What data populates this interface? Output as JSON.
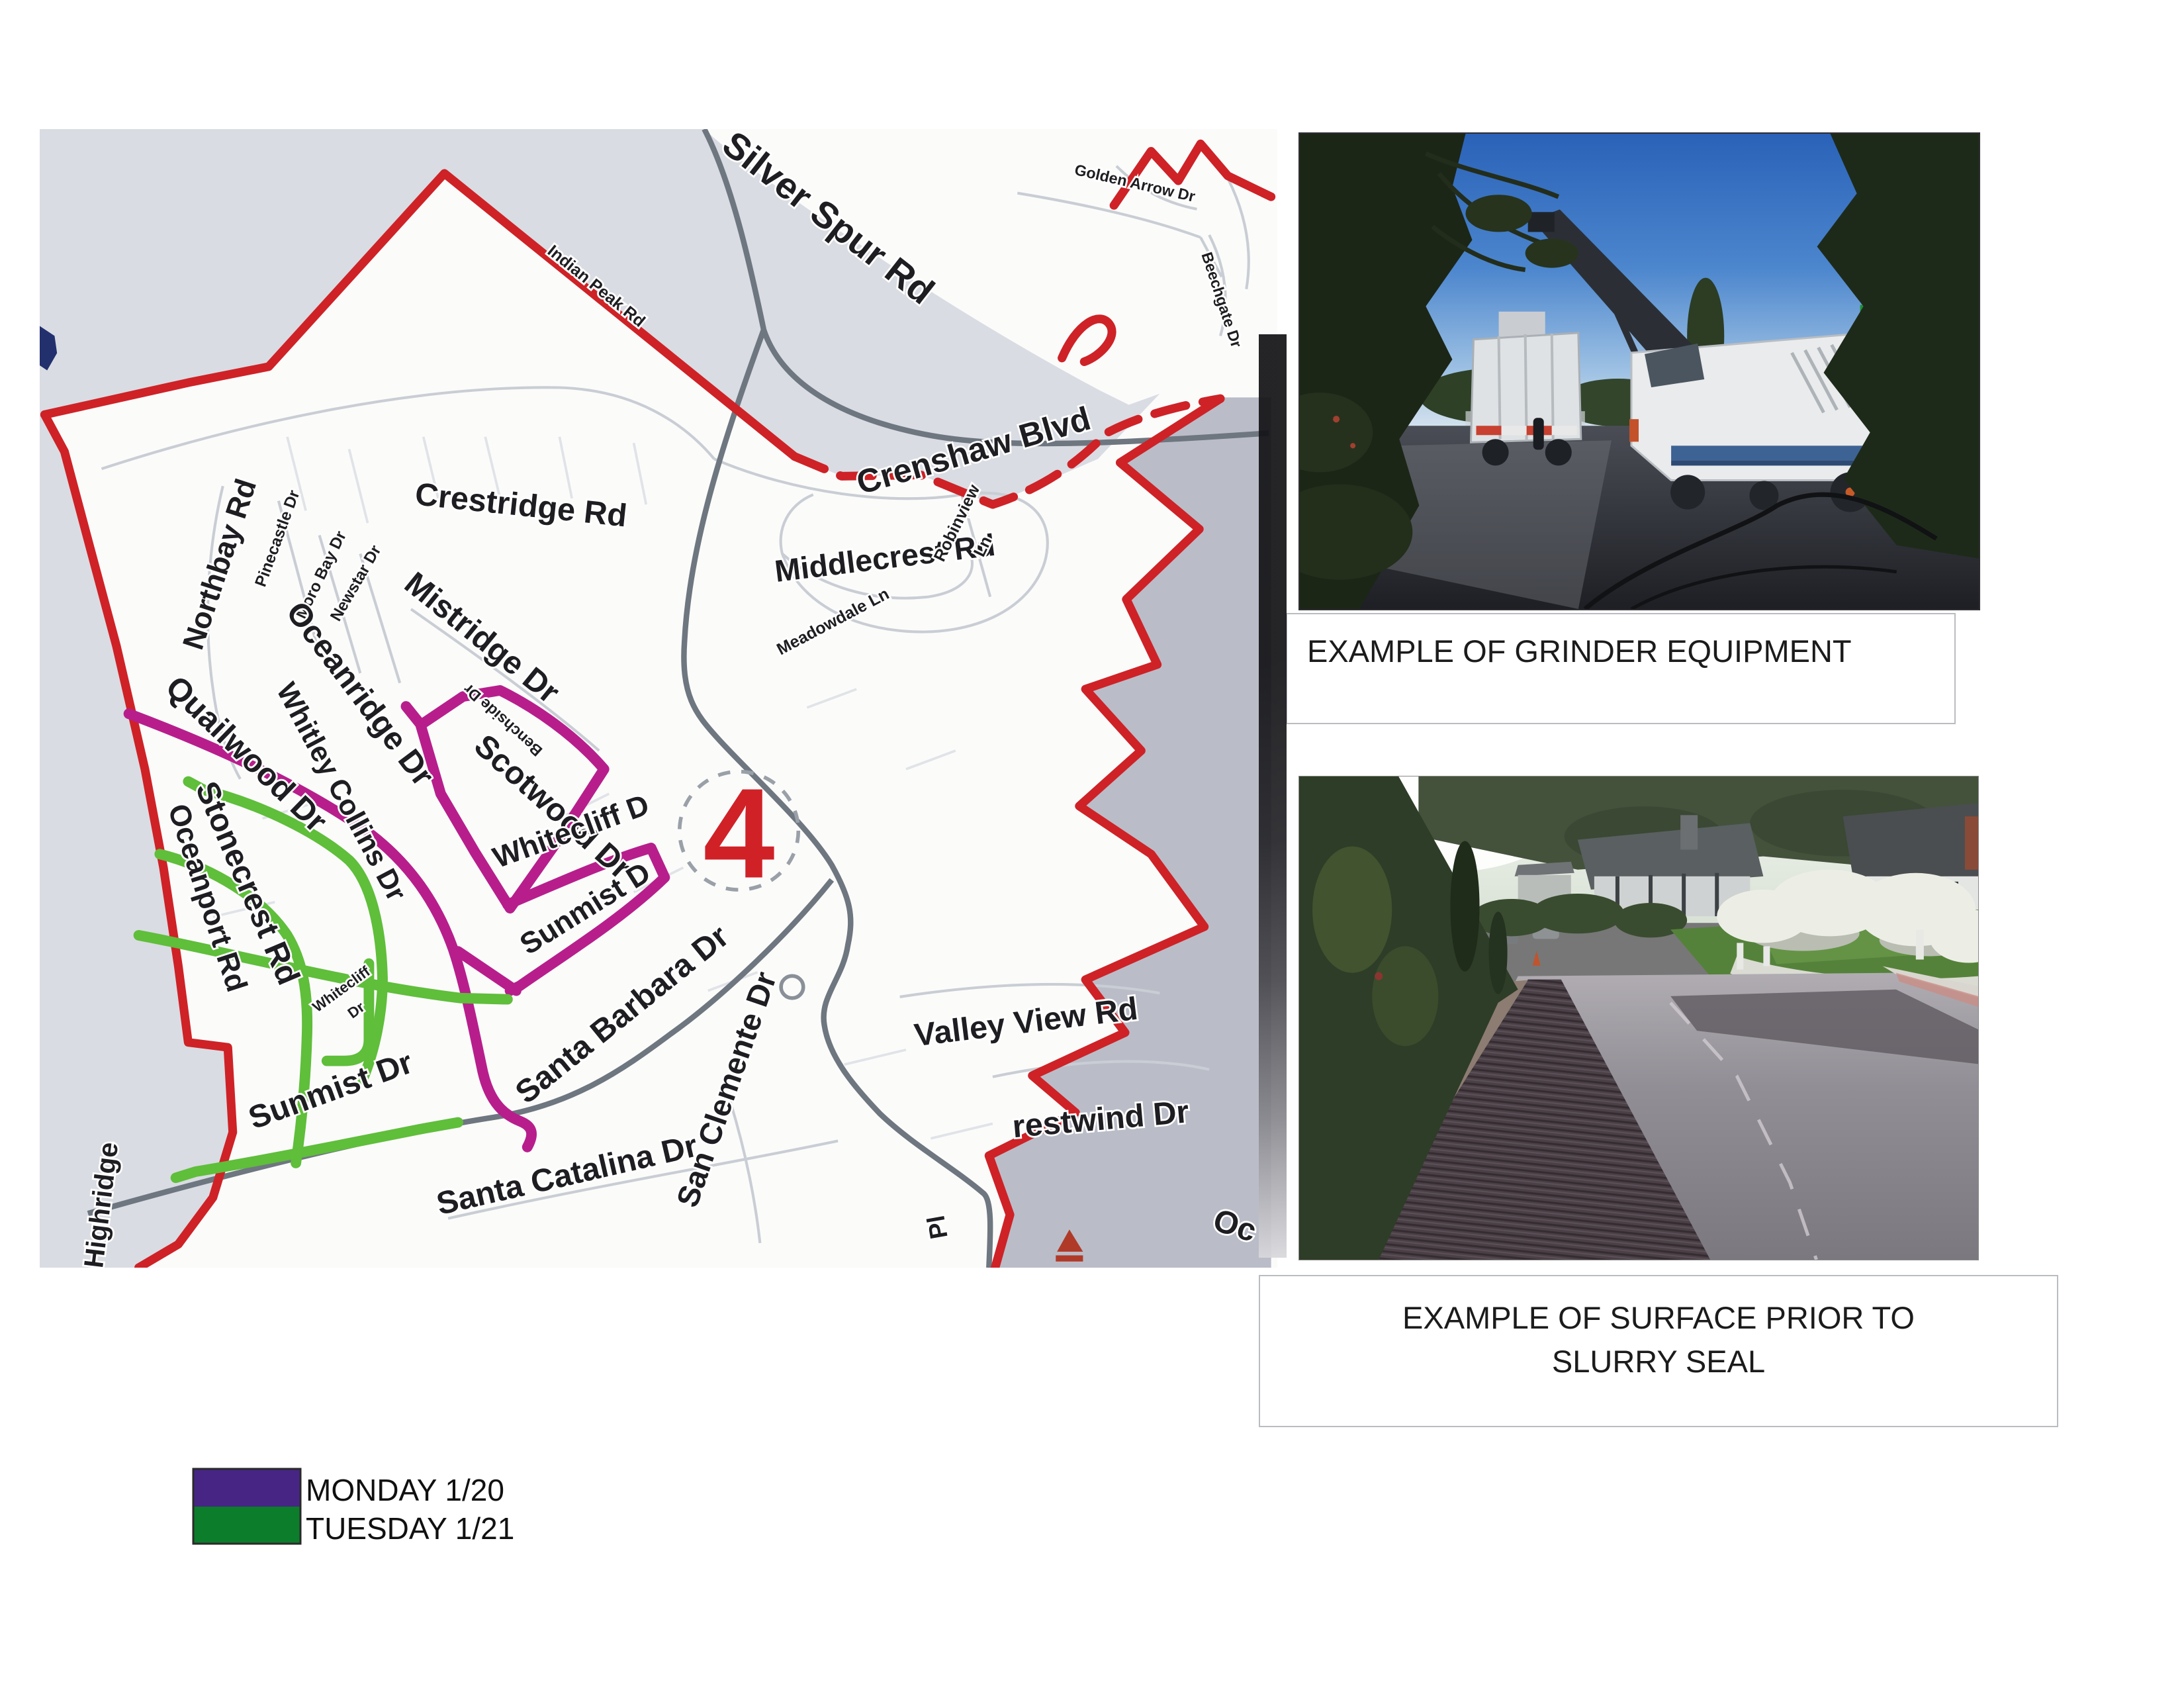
{
  "map": {
    "district_number": "4",
    "boundary_color": "#ce2227",
    "monday_route_color": "#b71e8c",
    "tuesday_route_color": "#5fbe3a",
    "streets": {
      "silver_spur": "Silver Spur Rd",
      "golden_arrow": "Golden Arrow Dr",
      "beechgate": "Beechgate Dr",
      "indian_peak": "Indian Peak Rd",
      "crenshaw": "Crenshaw Blvd",
      "crestridge": "Crestridge Rd",
      "middlecrest": "Middlecrest Rd",
      "meadowdale": "Meadowdale Ln",
      "robinview_line1": "Robinview",
      "robinview_line2": "Ln",
      "northbay": "Northbay Rd",
      "pinecastle": "Pinecastle Dr",
      "moro_bay": "Moro Bay Dr",
      "newstar": "Newstar Dr",
      "mistridge": "Mistridge Dr",
      "oceanridge": "Oceanridge Dr",
      "benchside": "Benchside Dr",
      "scotwood": "Scotwood Dr",
      "whitley_collins": "Whitley Collins Dr",
      "quailwood": "Quailwood Dr",
      "stonecrest": "Stonecrest Rd",
      "oceanport": "Oceanport Rd",
      "whitecliff_monday": "Whitecliff D",
      "sunmist_monday": "Sunmist D",
      "whitecliff_tuesday_line1": "Whitecliff",
      "whitecliff_tuesday_line2": "Dr",
      "sunmist_tuesday": "Sunmist Dr",
      "santa_barbara": "Santa Barbara Dr",
      "san_clemente": "San Clemente Dr",
      "santa_catalina": "Santa Catalina Dr",
      "valley_view": "Valley View Rd",
      "crestwind_partial": "restwind Dr",
      "highridge": "Highridge",
      "ocean_partial": "Oc",
      "pl_partial": "Pl"
    }
  },
  "legend": {
    "items": [
      {
        "label": "MONDAY 1/20",
        "color": "#472584"
      },
      {
        "label": "TUESDAY 1/21",
        "color": "#0c7d2b"
      }
    ]
  },
  "captions": {
    "grinder": "EXAMPLE OF GRINDER EQUIPMENT",
    "surface_line1": "EXAMPLE OF SURFACE PRIOR TO",
    "surface_line2": "SLURRY SEAL"
  }
}
